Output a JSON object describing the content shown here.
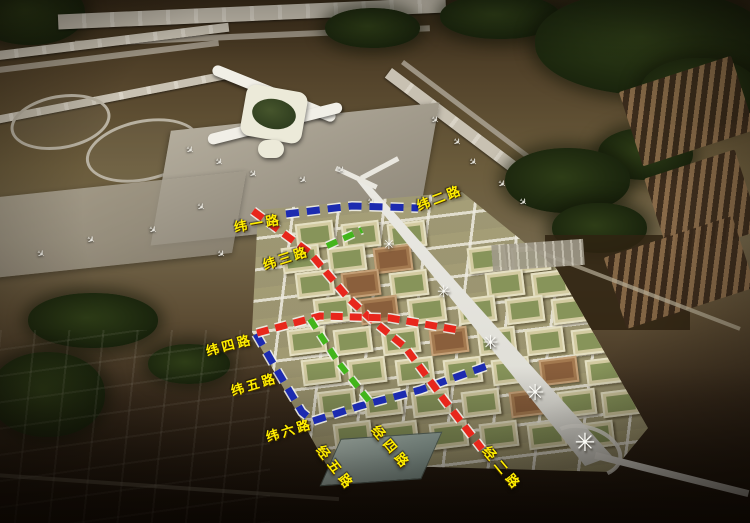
{
  "image": {
    "type": "aerial-airport-city-planning-rendering",
    "palette": {
      "dash_red": "#e8271c",
      "dash_blue": "#1c2bb0",
      "dash_green": "#43b51c",
      "label_yellow": "#ffee00",
      "route_outline": "#f5f5f0"
    },
    "road_labels": [
      {
        "id": "wei-1-road",
        "text": "纬一路",
        "x": 234,
        "y": 217,
        "rot": -10,
        "vert": false
      },
      {
        "id": "wei-2-road",
        "text": "纬二路",
        "x": 417,
        "y": 196,
        "rot": -21,
        "vert": false
      },
      {
        "id": "wei-3-road",
        "text": "纬三路",
        "x": 263,
        "y": 255,
        "rot": -18,
        "vert": false
      },
      {
        "id": "wei-4-road",
        "text": "纬四路",
        "x": 206,
        "y": 341,
        "rot": -15,
        "vert": false
      },
      {
        "id": "wei-5-road",
        "text": "纬五路",
        "x": 231,
        "y": 381,
        "rot": -17,
        "vert": false
      },
      {
        "id": "wei-6-road",
        "text": "纬六路",
        "x": 266,
        "y": 427,
        "rot": -17,
        "vert": false
      },
      {
        "id": "jing-5-road",
        "text": "经五路",
        "x": 320,
        "y": 437,
        "rot": 52,
        "vert": true
      },
      {
        "id": "jing-4-road",
        "text": "经四路",
        "x": 375,
        "y": 417,
        "rot": 50,
        "vert": true
      },
      {
        "id": "jing-2-road",
        "text": "经二路",
        "x": 486,
        "y": 438,
        "rot": 50,
        "vert": true
      }
    ],
    "dashed_routes": [
      {
        "id": "blue-route-north",
        "color": "#1c2bb0",
        "width": 7,
        "dash": "13 8",
        "points": [
          [
            286,
            214
          ],
          [
            352,
            206
          ],
          [
            418,
            208
          ]
        ]
      },
      {
        "id": "blue-route-southwest",
        "color": "#1c2bb0",
        "width": 7,
        "dash": "13 8",
        "points": [
          [
            256,
            334
          ],
          [
            278,
            372
          ],
          [
            302,
            412
          ],
          [
            313,
            421
          ],
          [
            360,
            406
          ],
          [
            420,
            390
          ],
          [
            487,
            366
          ]
        ]
      },
      {
        "id": "red-route-diagonal",
        "color": "#e8271c",
        "width": 7,
        "dash": "12 7",
        "points": [
          [
            253,
            211
          ],
          [
            310,
            253
          ],
          [
            348,
            298
          ],
          [
            372,
            320
          ],
          [
            405,
            347
          ],
          [
            445,
            401
          ],
          [
            482,
            449
          ]
        ]
      },
      {
        "id": "red-route-wei4",
        "color": "#e8271c",
        "width": 7,
        "dash": "12 7",
        "points": [
          [
            257,
            333
          ],
          [
            320,
            316
          ],
          [
            390,
            318
          ],
          [
            458,
            330
          ]
        ]
      },
      {
        "id": "green-route-north",
        "color": "#43b51c",
        "width": 6,
        "dash": "11 7",
        "points": [
          [
            327,
            246
          ],
          [
            362,
            230
          ]
        ]
      },
      {
        "id": "green-route-south",
        "color": "#43b51c",
        "width": 6,
        "dash": "11 7",
        "points": [
          [
            310,
            319
          ],
          [
            338,
            362
          ],
          [
            370,
            402
          ]
        ]
      }
    ],
    "white_markers": {
      "glyph": "✳",
      "points": [
        [
          390,
          244,
          14
        ],
        [
          445,
          290,
          16
        ],
        [
          492,
          341,
          19
        ],
        [
          537,
          392,
          22
        ],
        [
          587,
          440,
          25
        ]
      ]
    },
    "airplane_glyph": "✈",
    "airplanes": [
      [
        185,
        146,
        38
      ],
      [
        214,
        158,
        40
      ],
      [
        248,
        170,
        42
      ],
      [
        298,
        176,
        35
      ],
      [
        336,
        166,
        40
      ],
      [
        196,
        203,
        38
      ],
      [
        254,
        210,
        40
      ],
      [
        312,
        208,
        36
      ],
      [
        366,
        198,
        40
      ],
      [
        148,
        226,
        36
      ],
      [
        86,
        236,
        34
      ],
      [
        36,
        250,
        36
      ],
      [
        216,
        250,
        40
      ],
      [
        430,
        116,
        40
      ],
      [
        452,
        138,
        42
      ],
      [
        468,
        158,
        40
      ],
      [
        497,
        180,
        38
      ],
      [
        518,
        198,
        40
      ]
    ]
  }
}
